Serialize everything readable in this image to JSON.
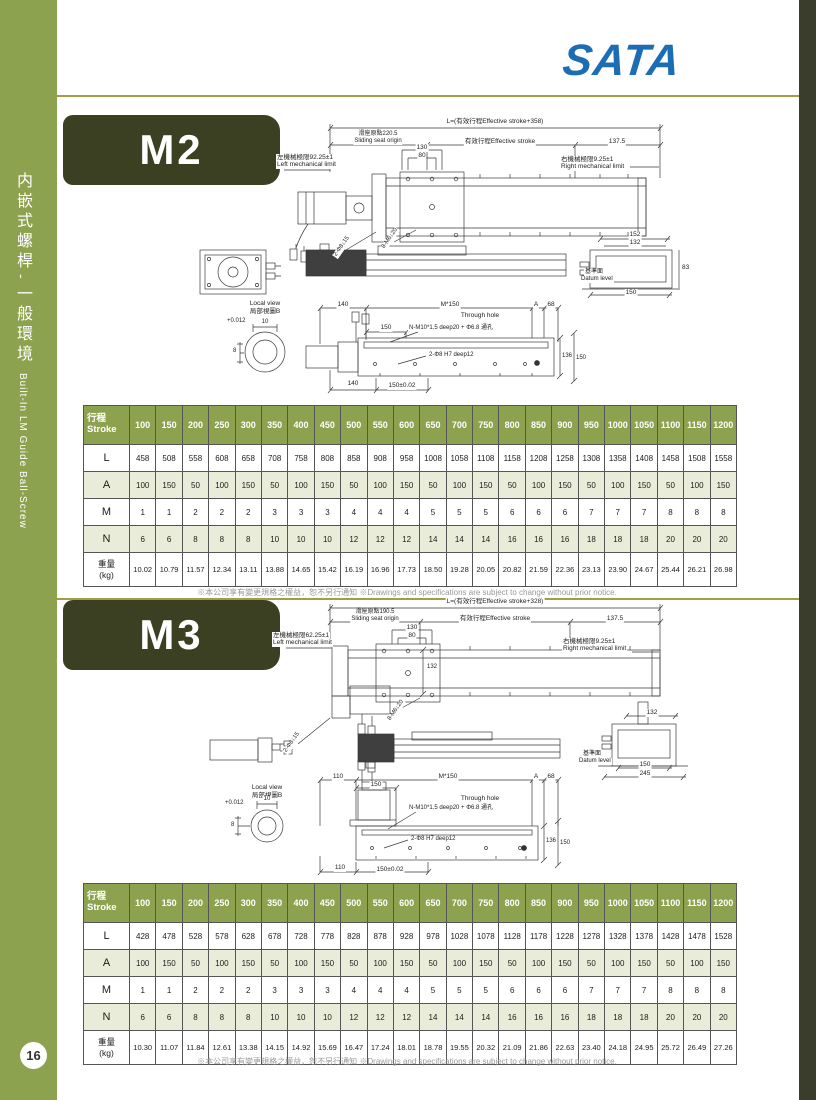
{
  "logo": {
    "text": "SATA"
  },
  "colors": {
    "band_green": "#8da24f",
    "badge_olive": "#3c4022",
    "table_tint": "#e9ecd9",
    "rule_gold": "#a59d43",
    "logo_blue": "#1d6db4",
    "right_strip": "#3a3c2c"
  },
  "sidebar": {
    "zh1": "内嵌式螺桿",
    "dash": "-",
    "zh2": "一般環境",
    "en": "Built-In LM Guide  Ball-Screw",
    "page_number": "16"
  },
  "footer_note": {
    "zh": "※本公司享有變更規格之權益，恕不另行通知",
    "en": "※Drawings and specifications are subject to change without prior notice."
  },
  "m2": {
    "label": "M2",
    "drawing": {
      "length_formula": "L=(有效行程Effective stroke+358)",
      "origin_zh": "滑座原點220.5",
      "origin_en": "Sliding seat origin",
      "effective_stroke": "有效行程Effective stroke",
      "dim_right_offset": "137.5",
      "left_limit_zh": "左機械極限92.25±1",
      "left_limit_en": "Left mechanical limit",
      "right_limit_zh": "右機械極限9.25±1",
      "right_limit_en": "Right mechanical limit",
      "dim_130": "130",
      "dim_80": "80",
      "callout_diag1": "2-Φ8↓15",
      "callout_diag2": "8-M6↓20",
      "section": {
        "w_outer": "152",
        "w_inner": "132",
        "h": "83",
        "w_base": "150",
        "datum_zh": "基準面",
        "datum_en": "Datum level"
      },
      "local_view_en": "Local view",
      "local_view_zh": "局部視圖B",
      "local_tol": "+0.012",
      "local_dim_10": "10",
      "local_dim_8": "8",
      "bottom": {
        "dim_first": "140",
        "pitch": "M*150",
        "through_hole": "Through hole",
        "dim_A": "A",
        "dim_68": "68",
        "dim_150": "150",
        "callout_holes": "N-M10*1.5 deep20 + Φ6.8 通孔",
        "callout_pins": "2-Φ8 H7 deep12",
        "dim_136": "136",
        "dim_150b": "150",
        "dim_first_b": "140",
        "dim_150tol": "150±0.02"
      }
    },
    "table": {
      "header_zh": "行程",
      "header_en": "Stroke",
      "strokes": [
        "100",
        "150",
        "200",
        "250",
        "300",
        "350",
        "400",
        "450",
        "500",
        "550",
        "600",
        "650",
        "700",
        "750",
        "800",
        "850",
        "900",
        "950",
        "1000",
        "1050",
        "1100",
        "1150",
        "1200"
      ],
      "rows": [
        {
          "label_lines": [
            "L"
          ],
          "values": [
            "458",
            "508",
            "558",
            "608",
            "658",
            "708",
            "758",
            "808",
            "858",
            "908",
            "958",
            "1008",
            "1058",
            "1108",
            "1158",
            "1208",
            "1258",
            "1308",
            "1358",
            "1408",
            "1458",
            "1508",
            "1558"
          ]
        },
        {
          "label_lines": [
            "A"
          ],
          "values": [
            "100",
            "150",
            "50",
            "100",
            "150",
            "50",
            "100",
            "150",
            "50",
            "100",
            "150",
            "50",
            "100",
            "150",
            "50",
            "100",
            "150",
            "50",
            "100",
            "150",
            "50",
            "100",
            "150"
          ]
        },
        {
          "label_lines": [
            "M"
          ],
          "values": [
            "1",
            "1",
            "2",
            "2",
            "2",
            "3",
            "3",
            "3",
            "4",
            "4",
            "4",
            "5",
            "5",
            "5",
            "6",
            "6",
            "6",
            "7",
            "7",
            "7",
            "8",
            "8",
            "8"
          ]
        },
        {
          "label_lines": [
            "N"
          ],
          "values": [
            "6",
            "6",
            "8",
            "8",
            "8",
            "10",
            "10",
            "10",
            "12",
            "12",
            "12",
            "14",
            "14",
            "14",
            "16",
            "16",
            "16",
            "18",
            "18",
            "18",
            "20",
            "20",
            "20"
          ]
        },
        {
          "label_lines": [
            "重量",
            "(kg)"
          ],
          "values": [
            "10.02",
            "10.79",
            "11.57",
            "12.34",
            "13.11",
            "13.88",
            "14.65",
            "15.42",
            "16.19",
            "16.96",
            "17.73",
            "18.50",
            "19.28",
            "20.05",
            "20.82",
            "21.59",
            "22.36",
            "23.13",
            "23.90",
            "24.67",
            "25.44",
            "26.21",
            "26.98"
          ]
        }
      ]
    }
  },
  "m3": {
    "label": "M3",
    "drawing": {
      "length_formula": "L=(有效行程Effective stroke+328)",
      "origin_zh": "滑座原點190.5",
      "origin_en": "Sliding seat origin",
      "effective_stroke": "有效行程Effective stroke",
      "dim_right_offset": "137.5",
      "left_limit_zh": "左機械極限62.25±1",
      "left_limit_en": "Left mechanical limit",
      "right_limit_zh": "右機械極限9.25±1",
      "right_limit_en": "Right mechanical limit",
      "dim_130": "130",
      "dim_80": "80",
      "dim_132": "132",
      "callout_diag1": "2-Φ8↓15",
      "callout_diag2": "8-M6↓20",
      "section": {
        "w_top": "132",
        "w_base": "150",
        "w_total": "245",
        "datum_zh": "基準面",
        "datum_en": "Datum level"
      },
      "local_view_en": "Local view",
      "local_view_zh": "局部視圖B",
      "local_tol": "+0.012",
      "local_dim_10": "10",
      "local_dim_8": "8",
      "bottom": {
        "dim_first": "110",
        "pitch": "M*150",
        "through_hole": "Through hole",
        "dim_A": "A",
        "dim_68": "68",
        "dim_150": "150",
        "callout_holes": "N-M10*1.5 deep20 + Φ6.8 通孔",
        "callout_pins": "2-Φ8 H7 deep12",
        "dim_136": "136",
        "dim_150b": "150",
        "dim_first_b": "110",
        "dim_150tol": "150±0.02"
      }
    },
    "table": {
      "header_zh": "行程",
      "header_en": "Stroke",
      "strokes": [
        "100",
        "150",
        "200",
        "250",
        "300",
        "350",
        "400",
        "450",
        "500",
        "550",
        "600",
        "650",
        "700",
        "750",
        "800",
        "850",
        "900",
        "950",
        "1000",
        "1050",
        "1100",
        "1150",
        "1200"
      ],
      "rows": [
        {
          "label_lines": [
            "L"
          ],
          "values": [
            "428",
            "478",
            "528",
            "578",
            "628",
            "678",
            "728",
            "778",
            "828",
            "878",
            "928",
            "978",
            "1028",
            "1078",
            "1128",
            "1178",
            "1228",
            "1278",
            "1328",
            "1378",
            "1428",
            "1478",
            "1528"
          ]
        },
        {
          "label_lines": [
            "A"
          ],
          "values": [
            "100",
            "150",
            "50",
            "100",
            "150",
            "50",
            "100",
            "150",
            "50",
            "100",
            "150",
            "50",
            "100",
            "150",
            "50",
            "100",
            "150",
            "50",
            "100",
            "150",
            "50",
            "100",
            "150"
          ]
        },
        {
          "label_lines": [
            "M"
          ],
          "values": [
            "1",
            "1",
            "2",
            "2",
            "2",
            "3",
            "3",
            "3",
            "4",
            "4",
            "4",
            "5",
            "5",
            "5",
            "6",
            "6",
            "6",
            "7",
            "7",
            "7",
            "8",
            "8",
            "8"
          ]
        },
        {
          "label_lines": [
            "N"
          ],
          "values": [
            "6",
            "6",
            "8",
            "8",
            "8",
            "10",
            "10",
            "10",
            "12",
            "12",
            "12",
            "14",
            "14",
            "14",
            "16",
            "16",
            "16",
            "18",
            "18",
            "18",
            "20",
            "20",
            "20"
          ]
        },
        {
          "label_lines": [
            "重量",
            "(kg)"
          ],
          "values": [
            "10.30",
            "11.07",
            "11.84",
            "12.61",
            "13.38",
            "14.15",
            "14.92",
            "15.69",
            "16.47",
            "17.24",
            "18.01",
            "18.78",
            "19.55",
            "20.32",
            "21.09",
            "21.86",
            "22.63",
            "23.40",
            "24.18",
            "24.95",
            "25.72",
            "26.49",
            "27.26"
          ]
        }
      ]
    }
  }
}
